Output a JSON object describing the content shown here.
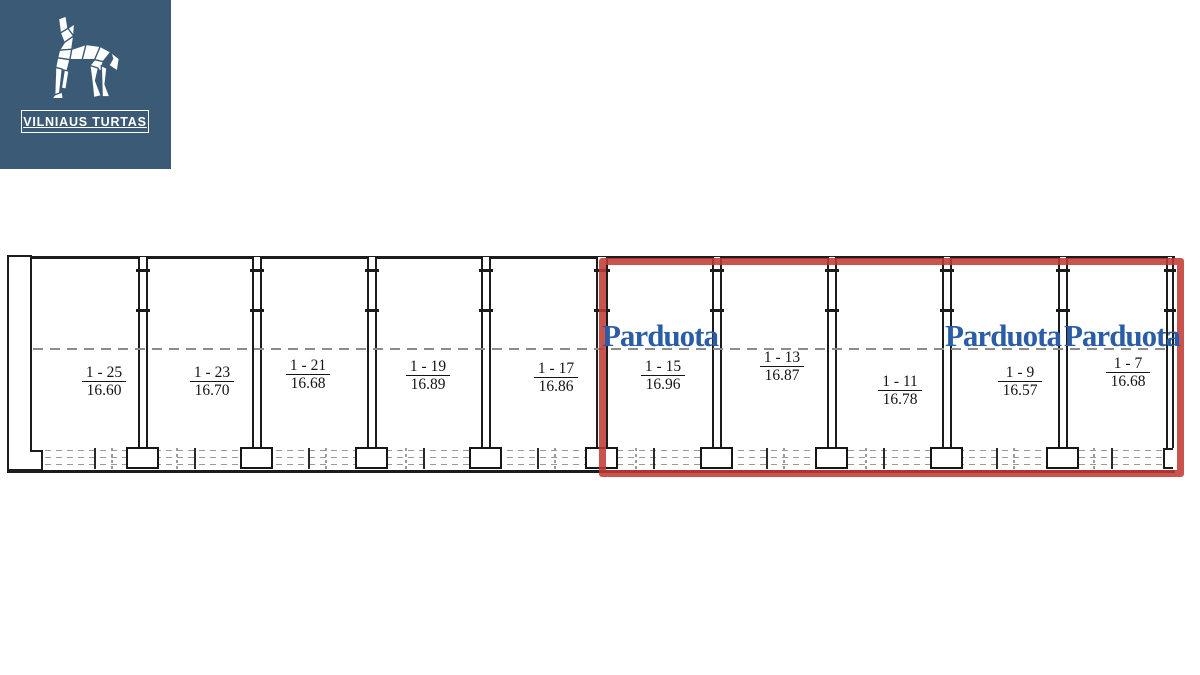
{
  "logo": {
    "brand": "VILNIAUS TURTAS",
    "bg_color": "#3b5a76"
  },
  "plan": {
    "sold_label": "Parduota",
    "highlight_color": "#c23b33",
    "sold_text_color": "#2a5da6",
    "units": [
      {
        "id": "1 - 25",
        "area": "16.60",
        "sold": false
      },
      {
        "id": "1 - 23",
        "area": "16.70",
        "sold": false
      },
      {
        "id": "1 - 21",
        "area": "16.68",
        "sold": false
      },
      {
        "id": "1 - 19",
        "area": "16.89",
        "sold": false
      },
      {
        "id": "1 - 17",
        "area": "16.86",
        "sold": false
      },
      {
        "id": "1 - 15",
        "area": "16.96",
        "sold": true
      },
      {
        "id": "1 - 13",
        "area": "16.87",
        "sold": false
      },
      {
        "id": "1 - 11",
        "area": "16.78",
        "sold": false
      },
      {
        "id": "1 - 9",
        "area": "16.57",
        "sold": true
      },
      {
        "id": "1 - 7",
        "area": "16.68",
        "sold": true
      }
    ]
  }
}
